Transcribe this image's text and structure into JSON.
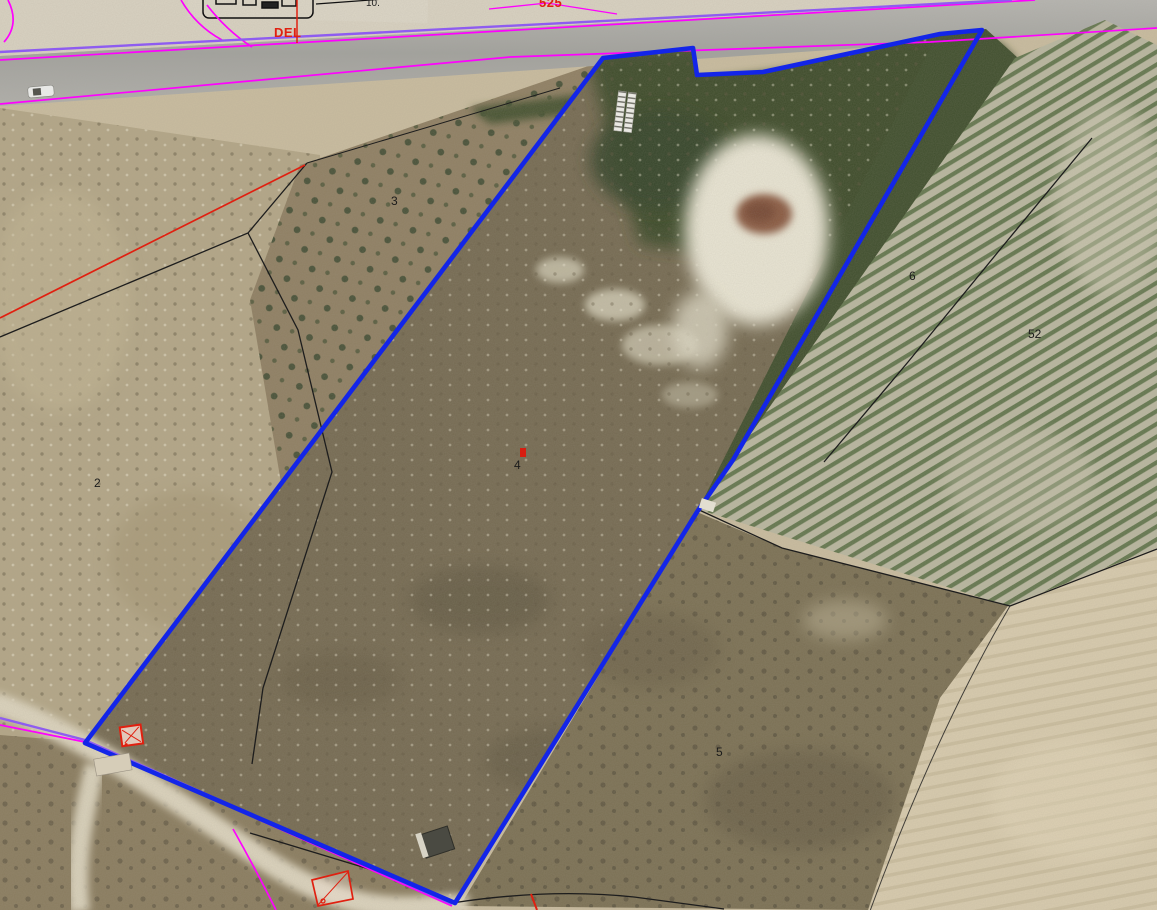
{
  "map": {
    "labels": {
      "road_text": "DEL",
      "road_number_partial": "525",
      "top_small_number": "10.",
      "parcel_2": "2",
      "parcel_3": "3",
      "parcel_4": "4",
      "parcel_5": "5",
      "parcel_6": "6",
      "parcel_52": "52"
    },
    "colors": {
      "selection_outline": "#1325e8",
      "cadastral_magenta": "#ff00ff",
      "easement_purple": "#8e5cf0",
      "annotation_red": "#e02010",
      "boundary_black": "#1d1d1d"
    }
  }
}
